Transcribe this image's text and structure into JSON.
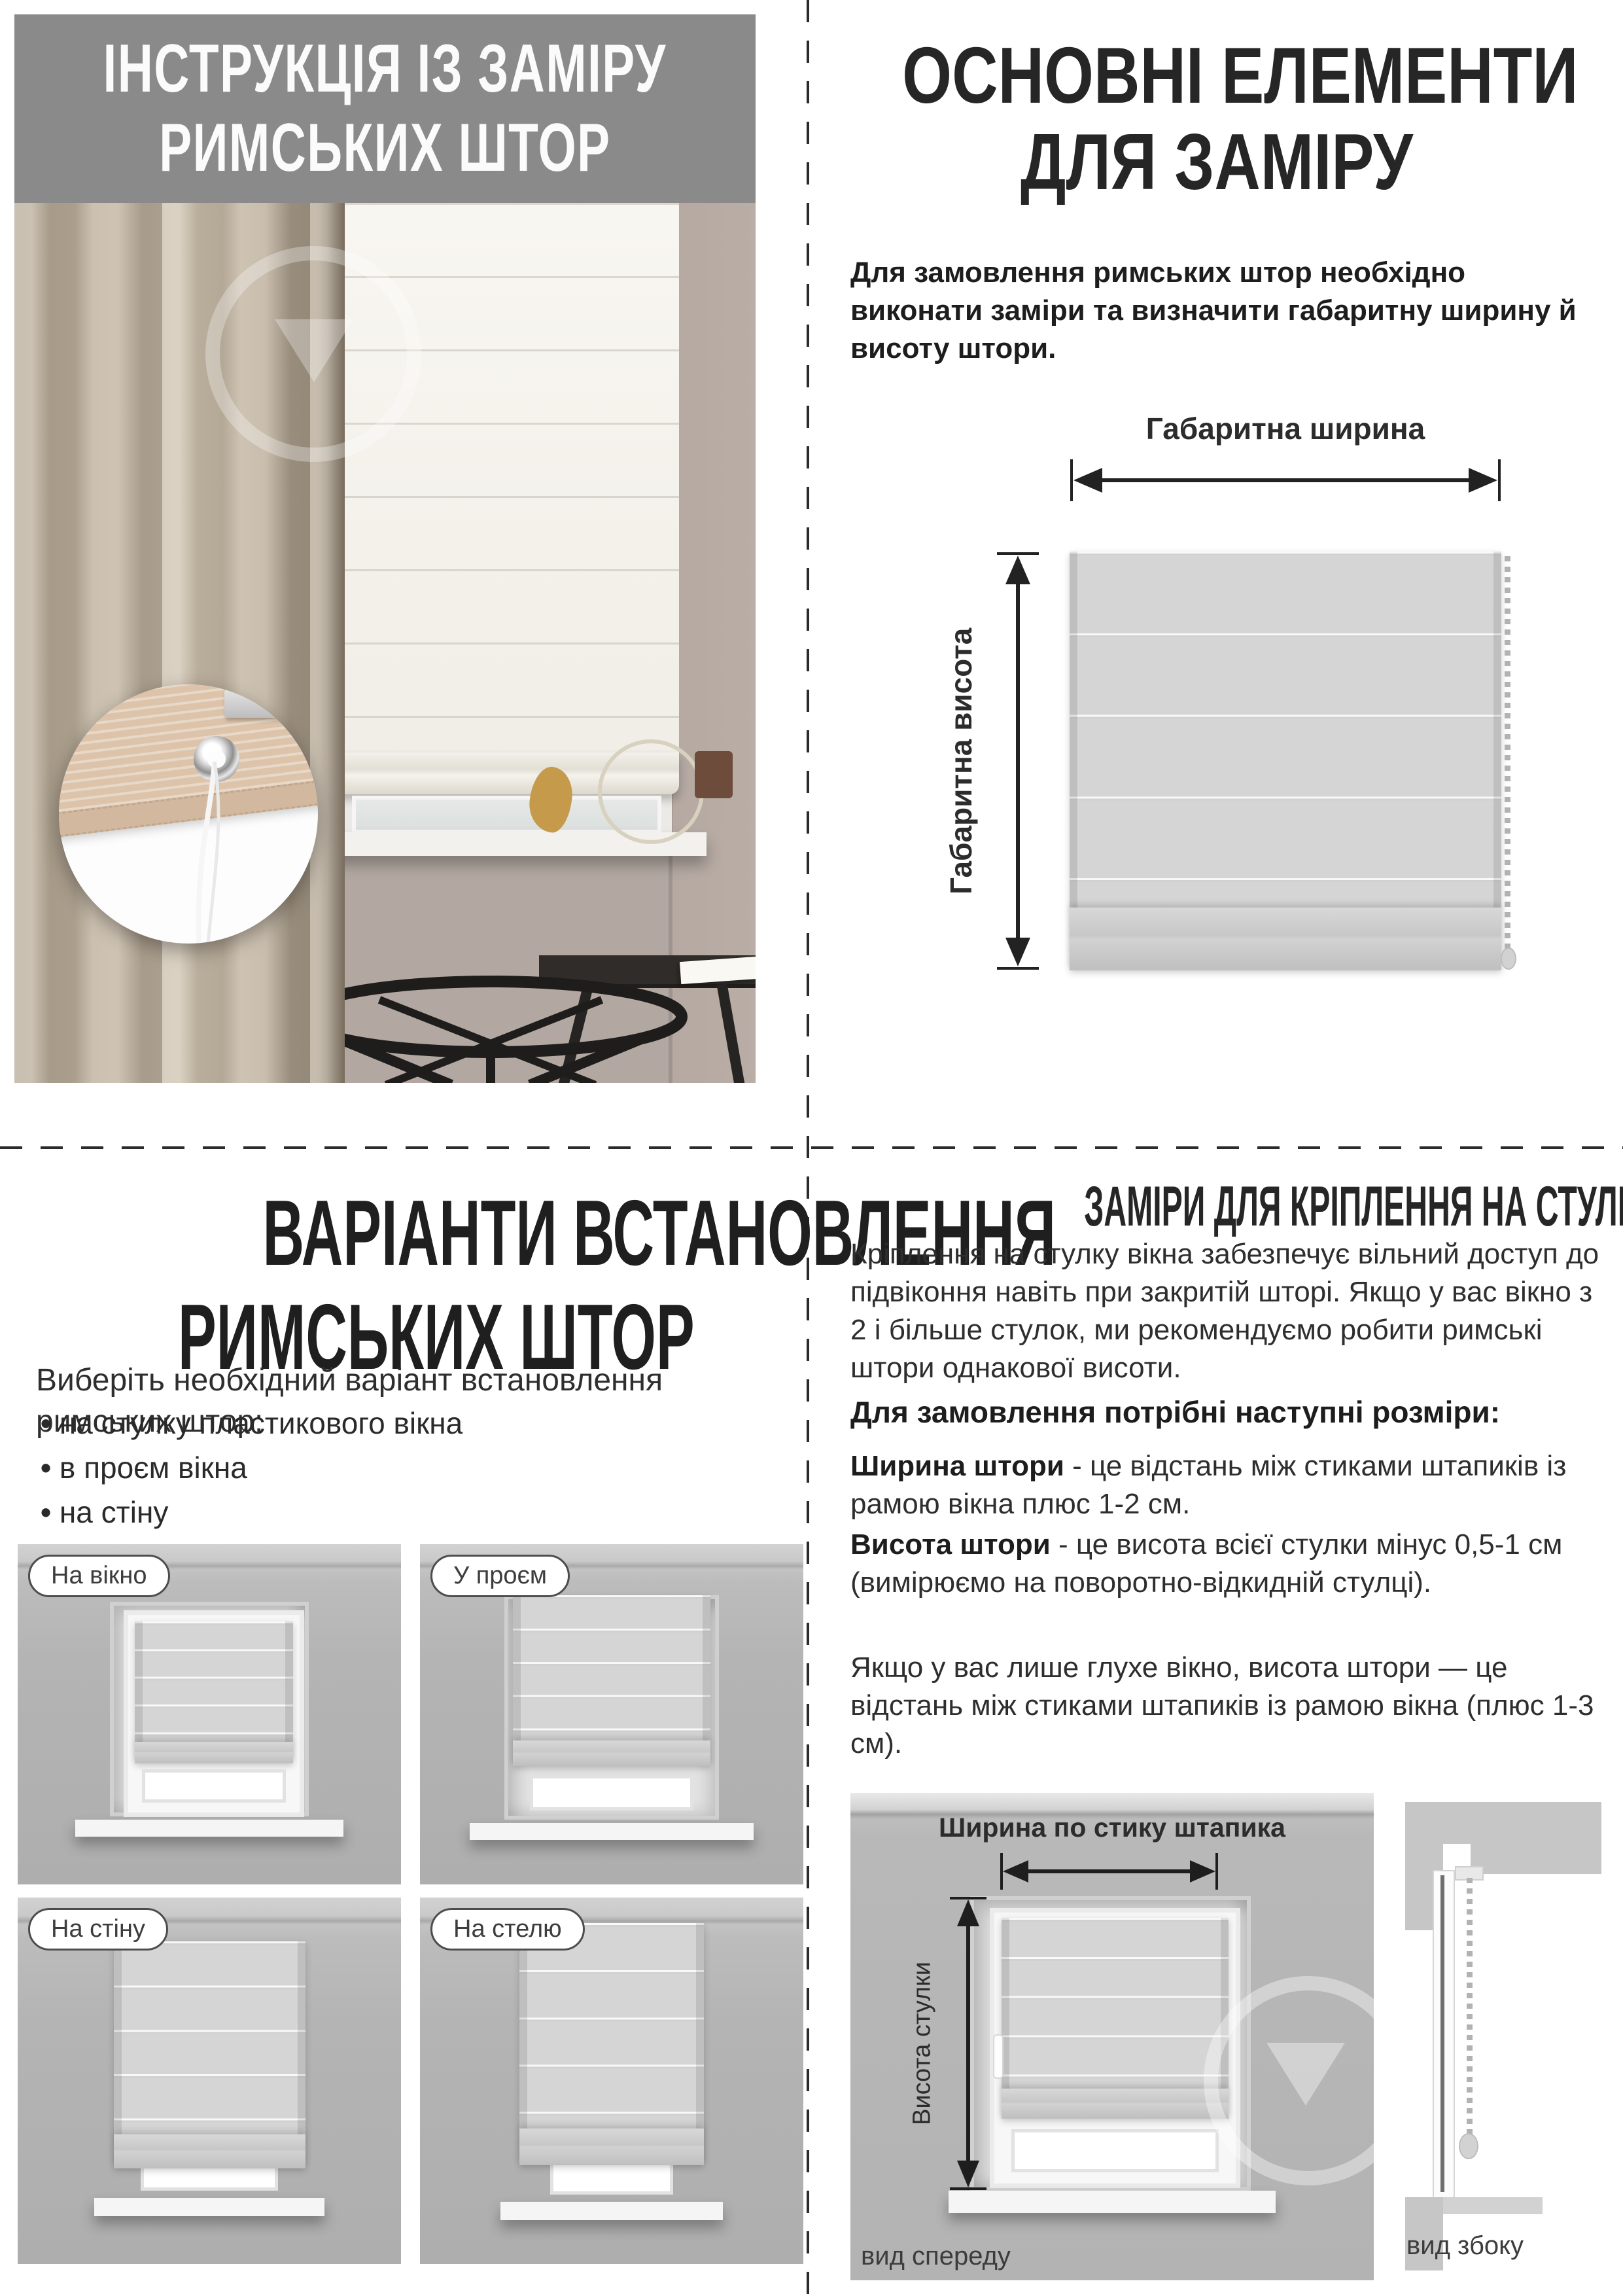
{
  "colors": {
    "header_bg": "#8a8a8a",
    "text_dark": "#262626",
    "card_wall": "#b4b4b4",
    "arrow": "#222222"
  },
  "top_left": {
    "title_line1": "ІНСТРУКЦІЯ ІЗ ЗАМІРУ",
    "title_line2": "РИМСЬКИХ ШТОР"
  },
  "top_right": {
    "title_line1": "ОСНОВНІ ЕЛЕМЕНТИ",
    "title_line2": "ДЛЯ ЗАМІРУ",
    "intro": "Для замовлення римських штор необхідно виконати заміри та визначити габаритну ширину й висоту штори.",
    "width_label": "Габаритна ширина",
    "height_label": "Габаритна висота"
  },
  "bottom_left": {
    "title_line1": "ВАРІАНТИ ВСТАНОВЛЕННЯ",
    "title_line2": "РИМСЬКИХ ШТОР",
    "subtitle": "Виберіть необхідний варіант встановлення римських штор:",
    "bullets": [
      "на стулку пластикового вікна",
      "в проєм вікна",
      "на стіну",
      "на стелю"
    ],
    "options": [
      "На вікно",
      "У проєм",
      "На стіну",
      "На стелю"
    ]
  },
  "bottom_right": {
    "title": "ЗАМІРИ ДЛЯ КРІПЛЕННЯ НА СТУЛКУ ВІКНА",
    "paragraph": "Кріплення на стулку вікна забезпечує вільний доступ до підвіконня навіть при закритій шторі. Якщо у вас вікно з 2 і більше стулок, ми рекомендуємо робити римські штори однакової висоти.",
    "sizes_heading": "Для замовлення потрібні наступні розміри:",
    "width_term": "Ширина штори",
    "width_def": " - це відстань між стиками штапиків із рамою вікна плюс 1-2 см.",
    "height_term": "Висота штори",
    "height_def": " - це висота всієї стулки мінус 0,5-1 см (вимірюємо на поворотно-відкидній стулці).",
    "note": "Якщо у вас лише глухе вікно, висота штори — це відстань між стиками штапиків із рамою вікна (плюс 1-3 см).",
    "front_width_label": "Ширина по стику штапика",
    "front_height_label": "Висота стулки",
    "front_caption": "вид спереду",
    "side_caption": "вид збоку"
  }
}
